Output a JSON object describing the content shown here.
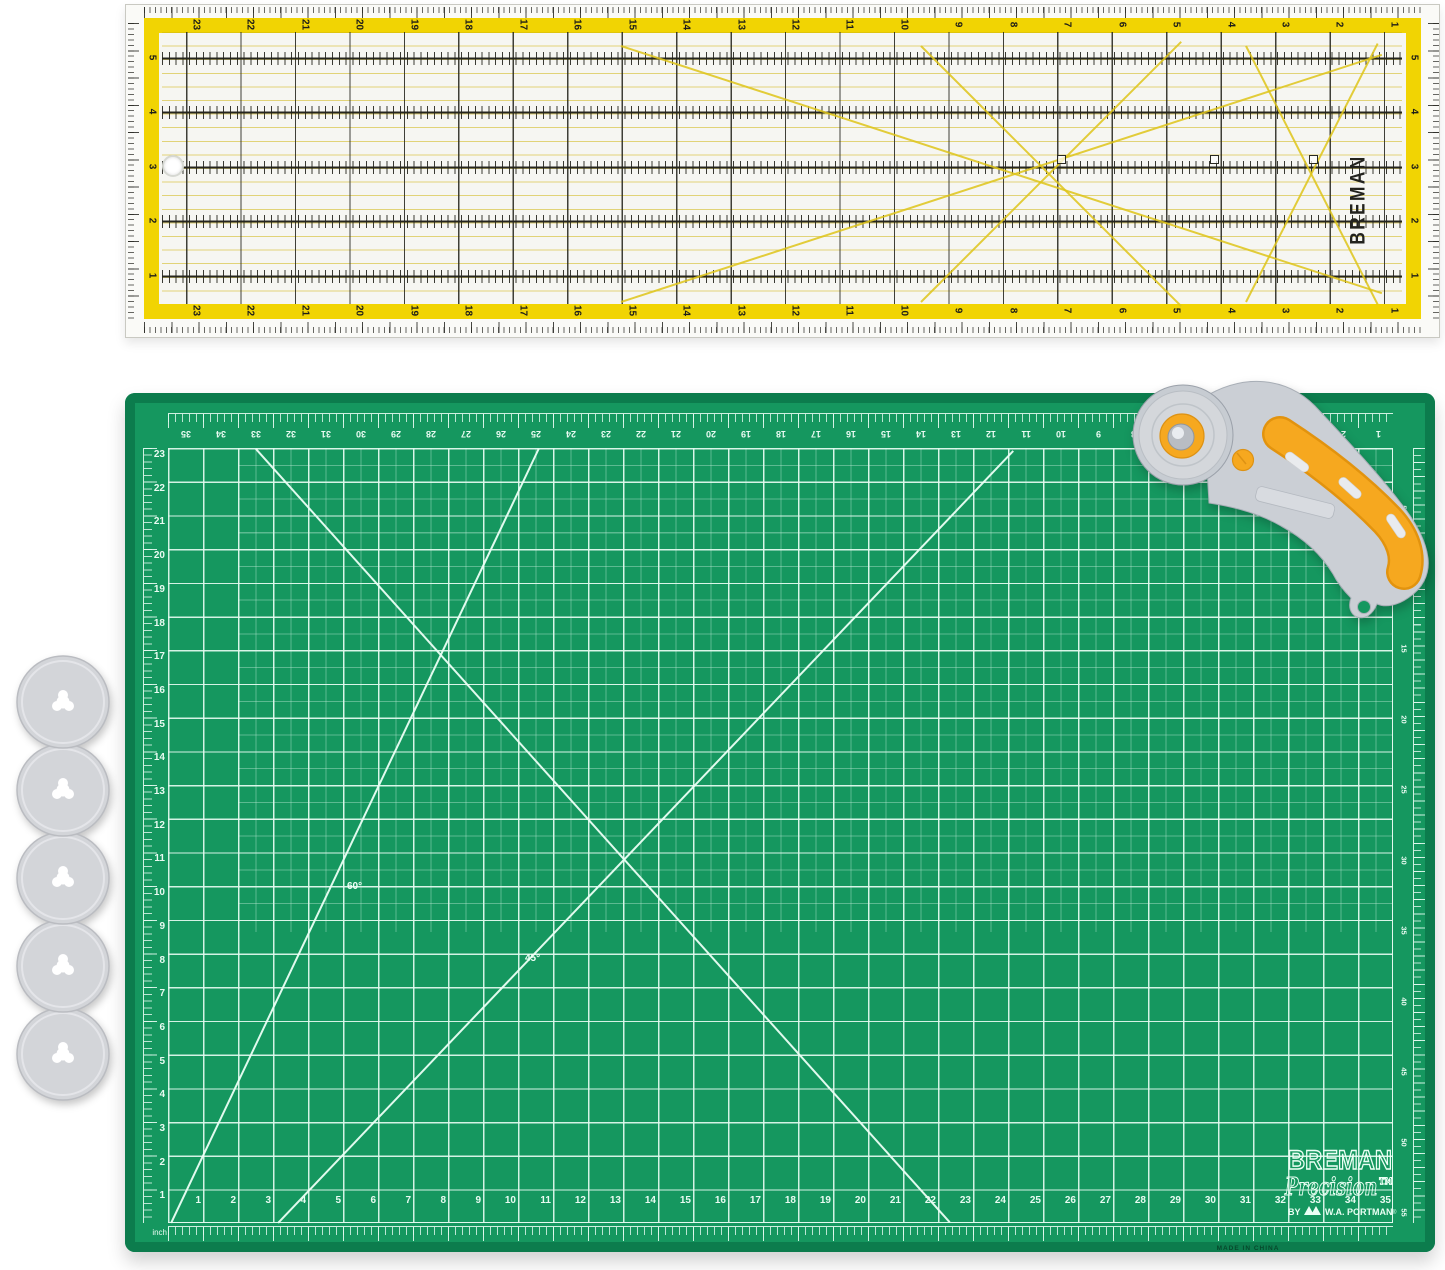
{
  "colors": {
    "background": "#ffffff",
    "mat_green": "#15975f",
    "mat_border_green": "#0c7c4d",
    "mat_grid_line": "#e4faf0",
    "ruler_yellow": "#f1d403",
    "ruler_line_black": "#25251e",
    "cutter_orange": "#f6a81f",
    "cutter_gray": "#cbcfd5",
    "blade_gray": "#d2d4d8"
  },
  "ruler": {
    "brand": "BREMAN",
    "top_numbers": [
      "23",
      "22",
      "21",
      "20",
      "19",
      "18",
      "17",
      "16",
      "15",
      "14",
      "13",
      "12",
      "11",
      "10",
      "9",
      "8",
      "7",
      "6",
      "5",
      "4",
      "3",
      "2",
      "1"
    ],
    "bottom_numbers": [
      "23",
      "22",
      "21",
      "20",
      "19",
      "18",
      "17",
      "16",
      "15",
      "14",
      "13",
      "12",
      "11",
      "10",
      "9",
      "8",
      "7",
      "6",
      "5",
      "4",
      "3",
      "2",
      "1"
    ],
    "left_numbers": [
      "5",
      "4",
      "3",
      "2",
      "1"
    ],
    "right_numbers": [
      "5",
      "4",
      "3",
      "2",
      "1"
    ]
  },
  "mat": {
    "brand_line1": "BREMAN",
    "brand_line2": "Precision™",
    "brand_by": "BY",
    "brand_name": "W.A. PORTMAN",
    "brand_reg": "®",
    "made_in": "MADE IN CHINA",
    "unit_label": "inch",
    "angle_label_60": "60°",
    "angle_label_45": "45°",
    "bottom_numbers": [
      "1",
      "2",
      "3",
      "4",
      "5",
      "6",
      "7",
      "8",
      "9",
      "10",
      "11",
      "12",
      "13",
      "14",
      "15",
      "16",
      "17",
      "18",
      "19",
      "20",
      "21",
      "22",
      "23",
      "24",
      "25",
      "26",
      "27",
      "28",
      "29",
      "30",
      "31",
      "32",
      "33",
      "34",
      "35"
    ],
    "left_numbers": [
      "23",
      "22",
      "21",
      "20",
      "19",
      "18",
      "17",
      "16",
      "15",
      "14",
      "13",
      "12",
      "11",
      "10",
      "9",
      "8",
      "7",
      "6",
      "5",
      "4",
      "3",
      "2",
      "1"
    ],
    "top_numbers": [
      "35",
      "34",
      "33",
      "32",
      "31",
      "30",
      "29",
      "28",
      "27",
      "26",
      "25",
      "24",
      "23",
      "22",
      "21",
      "20",
      "19",
      "18",
      "17",
      "16",
      "15",
      "14",
      "13",
      "12",
      "11",
      "10",
      "9",
      "8",
      "7",
      "6",
      "5",
      "4",
      "3",
      "2",
      "1"
    ],
    "right_cm_numbers": [
      "5",
      "10",
      "15",
      "20",
      "25",
      "30",
      "35",
      "40",
      "45",
      "50",
      "55"
    ]
  },
  "tools": {
    "rotary_cutter_name": "rotary cutter",
    "spare_blades_count": 5
  }
}
